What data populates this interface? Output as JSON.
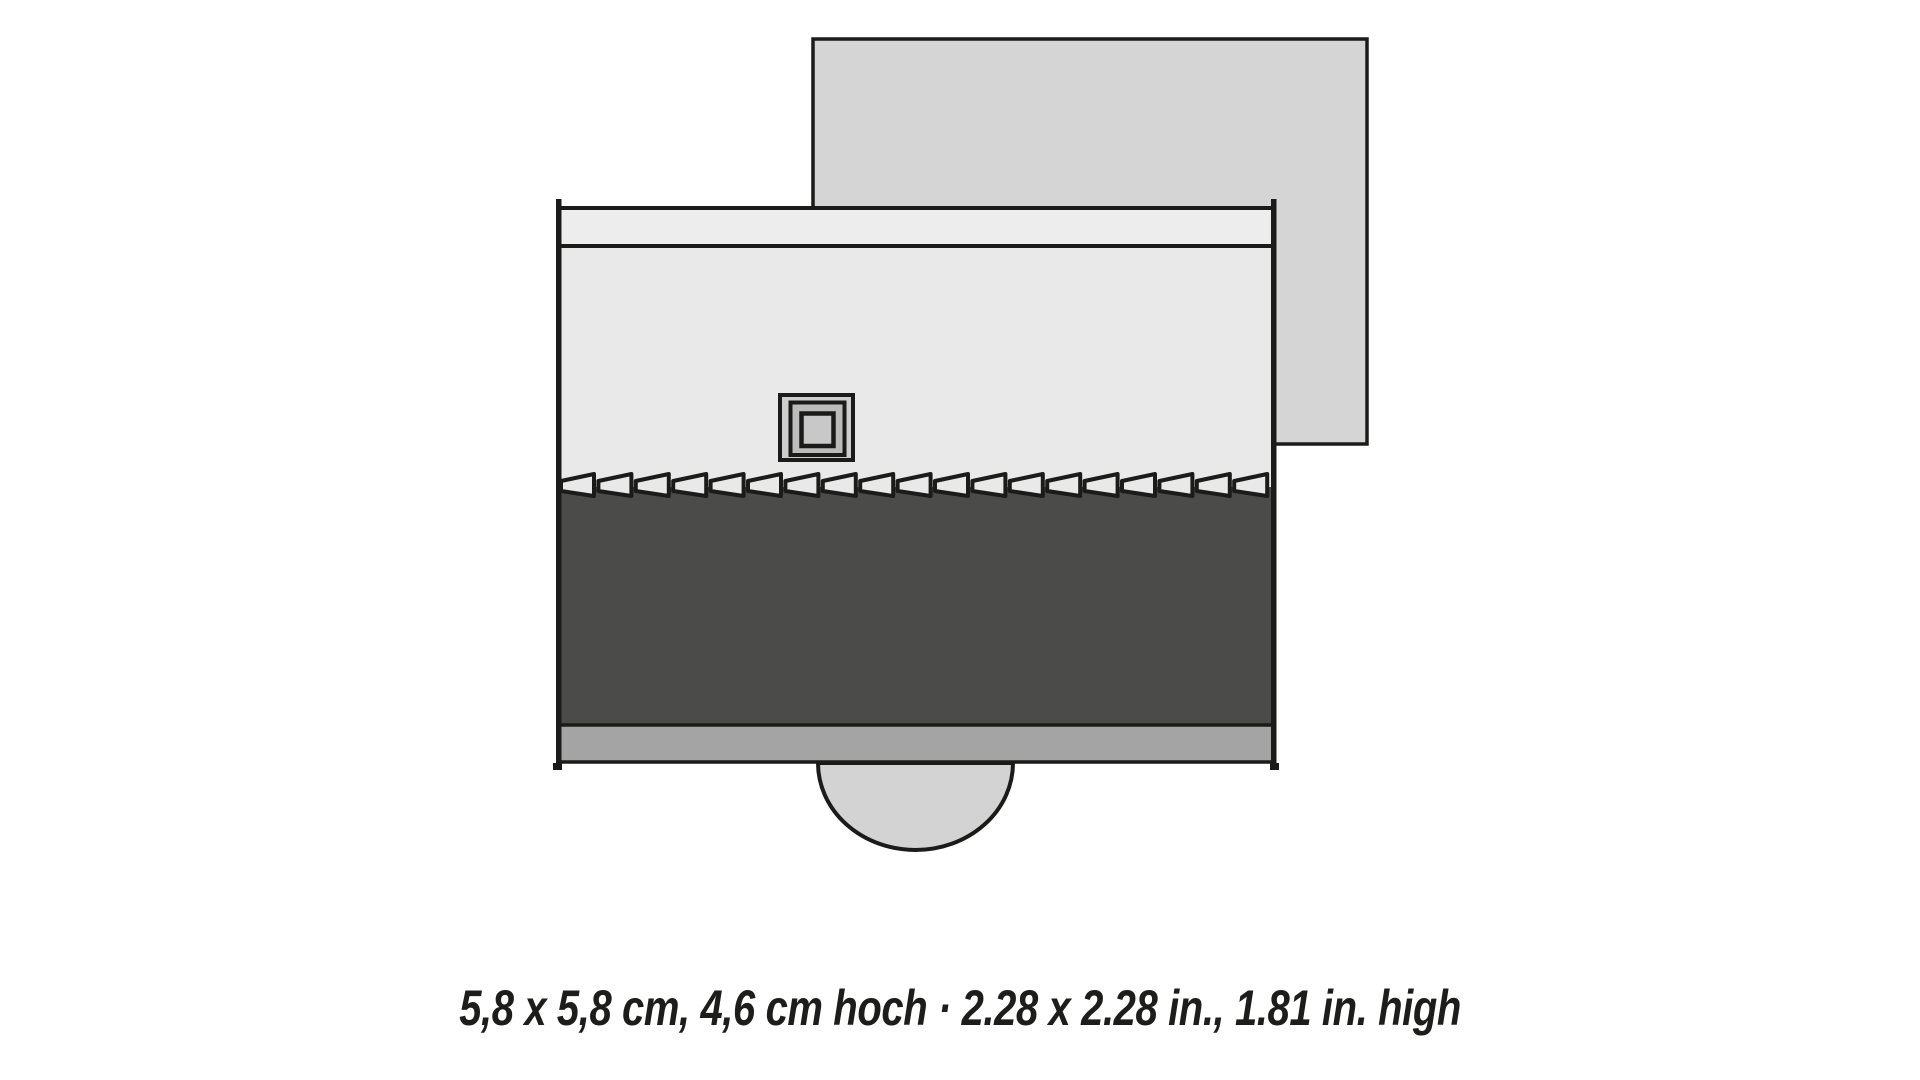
{
  "caption": {
    "text": "5,8 x 5,8 cm, 4,6 cm hoch · 2.28 x 2.28 in., 1.81 in. high"
  },
  "figure": {
    "teeth_count": 19,
    "colors": {
      "outline": "#1b1b19",
      "backdrop": "#d5d5d5",
      "light": "#e9e9e9",
      "band": "#ededed",
      "dark": "#4b4b49",
      "strip": "#a4a4a4",
      "arch": "#d3d3d3",
      "chimney-outer": "#cecece",
      "chimney-mid": "#bcbcbc",
      "chimney-inner": "#c8c8c8",
      "text": "#1d1d1b"
    }
  }
}
